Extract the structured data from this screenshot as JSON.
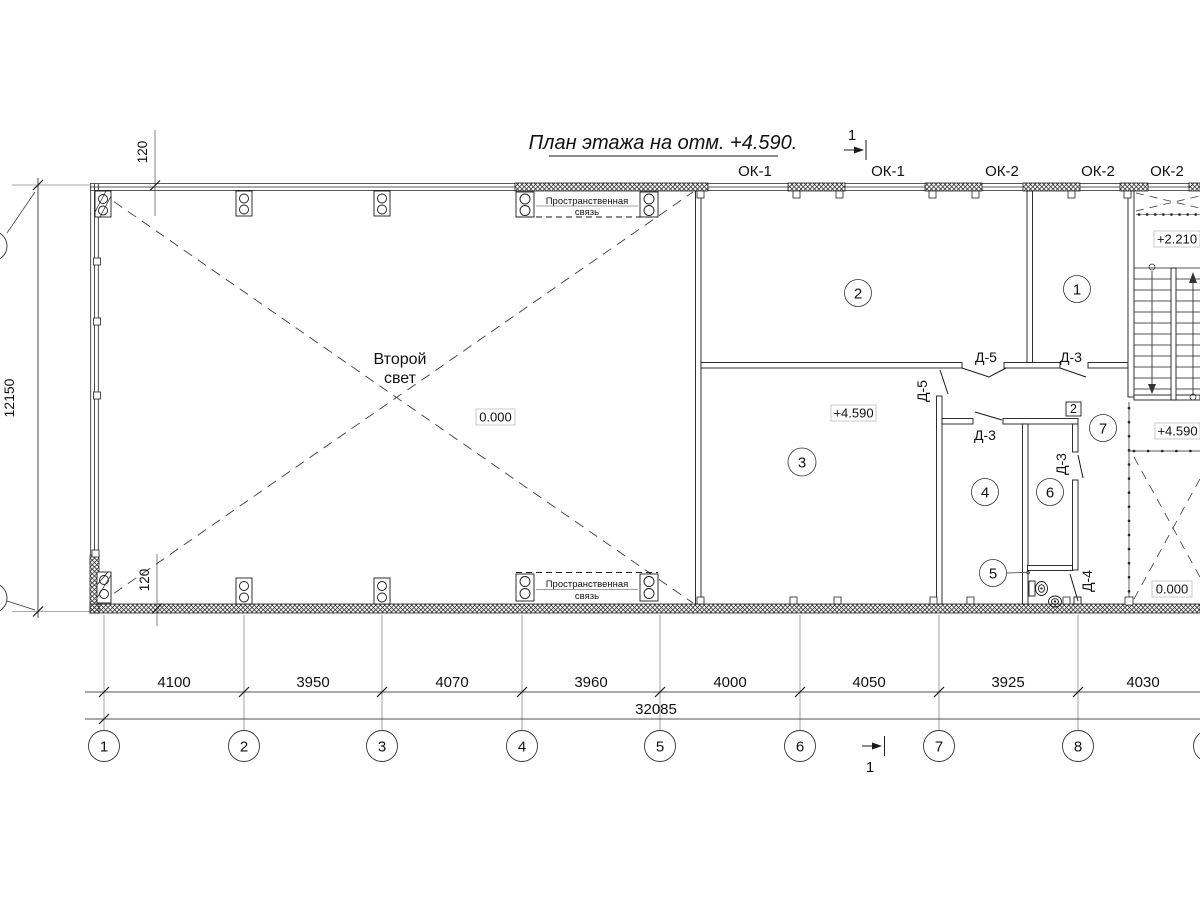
{
  "drawing": {
    "title": "План этажа на отм. +4.590.",
    "section_mark_label": "1"
  },
  "window_labels": [
    {
      "label": "ОК-1"
    },
    {
      "label": "ОК-1"
    },
    {
      "label": "ОК-2"
    },
    {
      "label": "ОК-2"
    },
    {
      "label": "ОК-2"
    }
  ],
  "rooms": [
    {
      "number": "1"
    },
    {
      "number": "2"
    },
    {
      "number": "3"
    },
    {
      "number": "4"
    },
    {
      "number": "5"
    },
    {
      "number": "6"
    },
    {
      "number": "7"
    }
  ],
  "doors": [
    {
      "label": "Д-5"
    },
    {
      "label": "Д-3"
    },
    {
      "label": "Д-5"
    },
    {
      "label": "Д-3"
    },
    {
      "label": "Д-3"
    },
    {
      "label": "Д-4"
    }
  ],
  "elevations": {
    "hall": "0.000",
    "floor": "+4.590",
    "stair_mid": "+2.210",
    "stair_landing": "+4.590",
    "void": "0.000"
  },
  "annotations": {
    "second_light": {
      "line1": "Второй",
      "line2": "свет"
    },
    "spatial_brace": {
      "line1": "Пространственная",
      "line2": "связь"
    },
    "level_marker": "2"
  },
  "dimensions": {
    "bays": [
      "4100",
      "3950",
      "4070",
      "3960",
      "4000",
      "4050",
      "3925",
      "4030"
    ],
    "total": "32085",
    "side": "12150",
    "offset_top": "120",
    "offset_bottom": "120"
  },
  "axes": [
    {
      "n": "1"
    },
    {
      "n": "2"
    },
    {
      "n": "3"
    },
    {
      "n": "4"
    },
    {
      "n": "5"
    },
    {
      "n": "6"
    },
    {
      "n": "7"
    },
    {
      "n": "8"
    }
  ]
}
